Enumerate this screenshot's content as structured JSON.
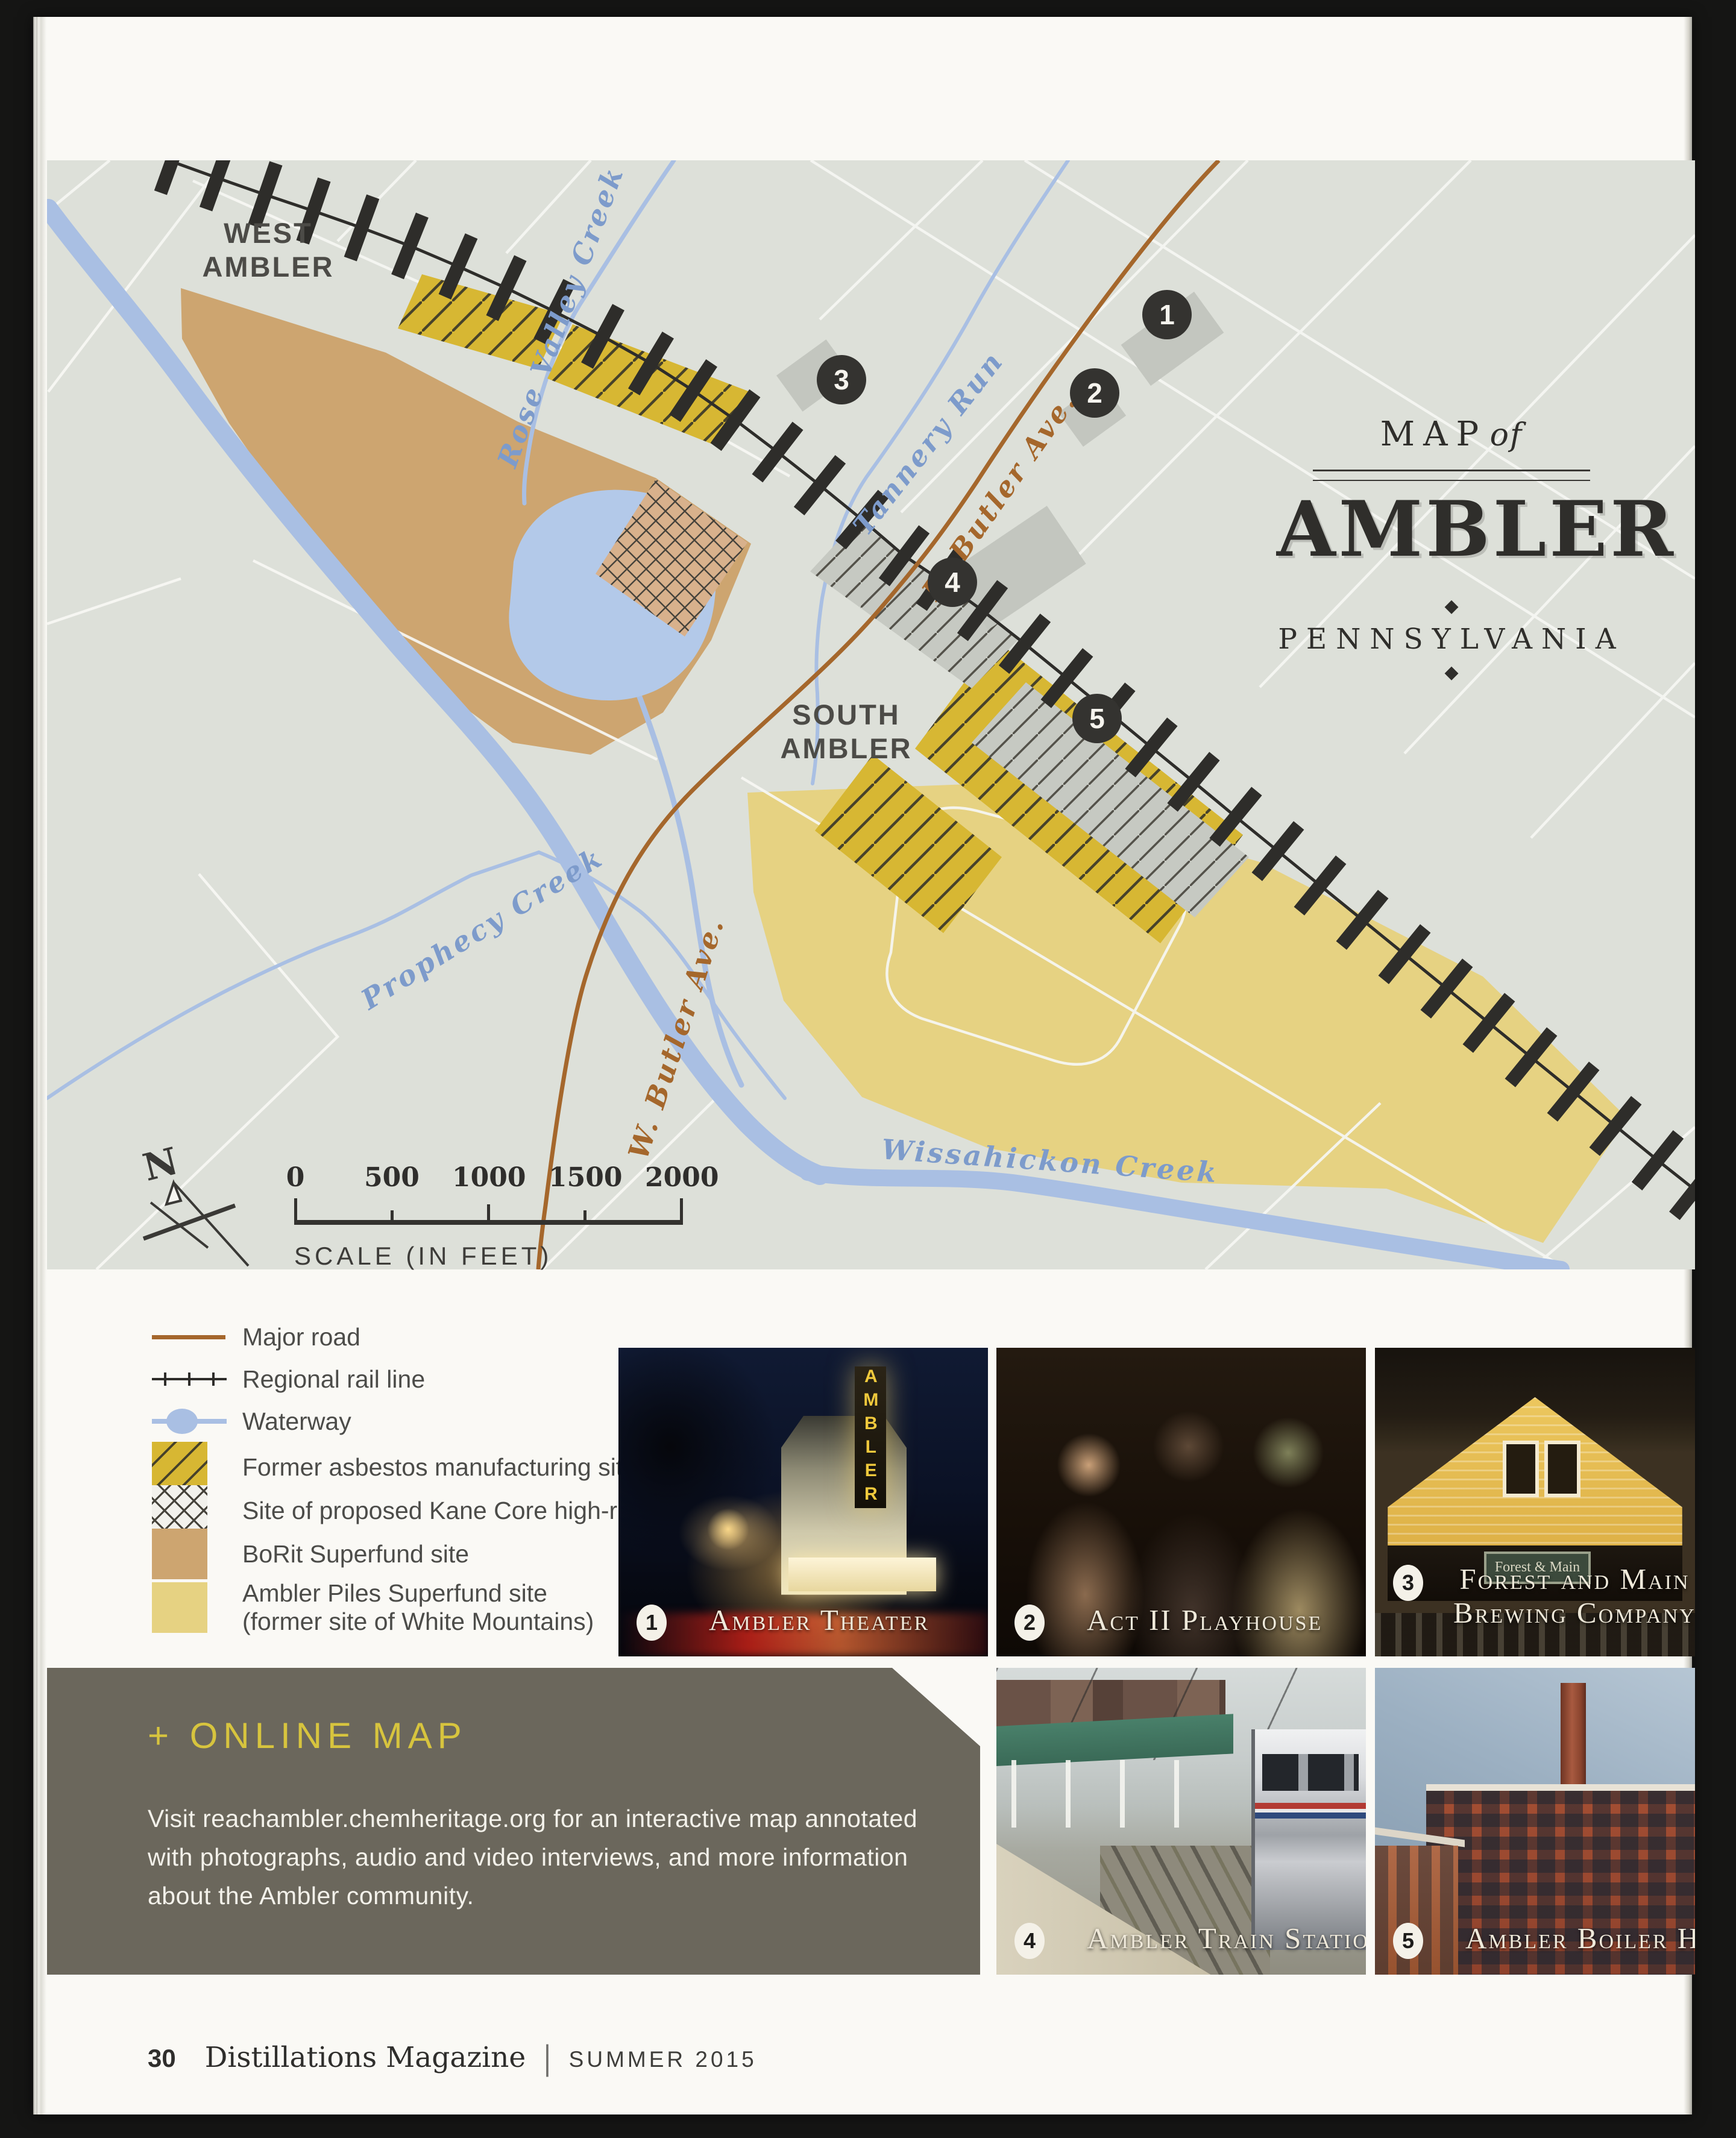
{
  "map": {
    "title": {
      "map_word": "MAP",
      "of_word": "of",
      "name": "AMBLER",
      "region": "PENNSYLVANIA",
      "ornament": "◆"
    },
    "labels": {
      "west_ambler": "WEST\nAMBLER",
      "south_ambler": "SOUTH\nAMBLER",
      "rose_valley_creek": "Rose Valley Creek",
      "tannery_run": "Tannery Run",
      "e_butler_ave": "E. Butler Ave.",
      "w_butler_ave": "W. Butler Ave.",
      "prophecy_creek": "Prophecy Creek",
      "wissahickon_creek": "Wissahickon Creek"
    },
    "markers": [
      {
        "label": "1"
      },
      {
        "label": "2"
      },
      {
        "label": "3"
      },
      {
        "label": "4"
      },
      {
        "label": "5"
      }
    ],
    "compass": {
      "north": "N"
    },
    "scale": {
      "ticks": [
        "0",
        "500",
        "1000",
        "1500",
        "2000"
      ],
      "caption": "SCALE (IN FEET)"
    }
  },
  "legend": {
    "items": [
      {
        "key": "major-road",
        "label": "Major road"
      },
      {
        "key": "rail",
        "label": "Regional rail line"
      },
      {
        "key": "waterway",
        "label": "Waterway"
      },
      {
        "key": "asbestos",
        "label": "Former asbestos manufacturing sites"
      },
      {
        "key": "kane",
        "label": "Site of proposed Kane Core high-rise"
      },
      {
        "key": "borit",
        "label": "BoRit Superfund site"
      },
      {
        "key": "piles",
        "label": "Ambler Piles Superfund site",
        "label2": "(former site of White Mountains)"
      }
    ]
  },
  "photos": [
    {
      "n": "1",
      "caption": "Ambler Theater",
      "sign": "AMBLER"
    },
    {
      "n": "2",
      "caption": "Act II Playhouse"
    },
    {
      "n": "3",
      "caption": "Forest and Main",
      "caption2": "Brewing Company",
      "sign": "Forest & Main"
    },
    {
      "n": "4",
      "caption": "Ambler Train Station"
    },
    {
      "n": "5",
      "caption": "Ambler Boiler House"
    }
  ],
  "online_map": {
    "heading": "+ ONLINE MAP",
    "body_lines": [
      "Visit reachambler.chemheritage.org for an interactive map annotated",
      "with photographs, audio and video interviews, and more information",
      "about the Ambler community."
    ]
  },
  "footer": {
    "page_number": "30",
    "magazine": "Distillations Magazine",
    "separator": "|",
    "issue": "SUMMER 2015"
  },
  "colors": {
    "map_background": "#dde0d9",
    "major_road": "#a5672c",
    "waterway": "#a9bfe3",
    "asbestos_site": "#d7b733",
    "borit_site": "#cda570",
    "piles_site": "#e6d282",
    "online_box": "#6b675c",
    "online_heading": "#d7c43e"
  }
}
